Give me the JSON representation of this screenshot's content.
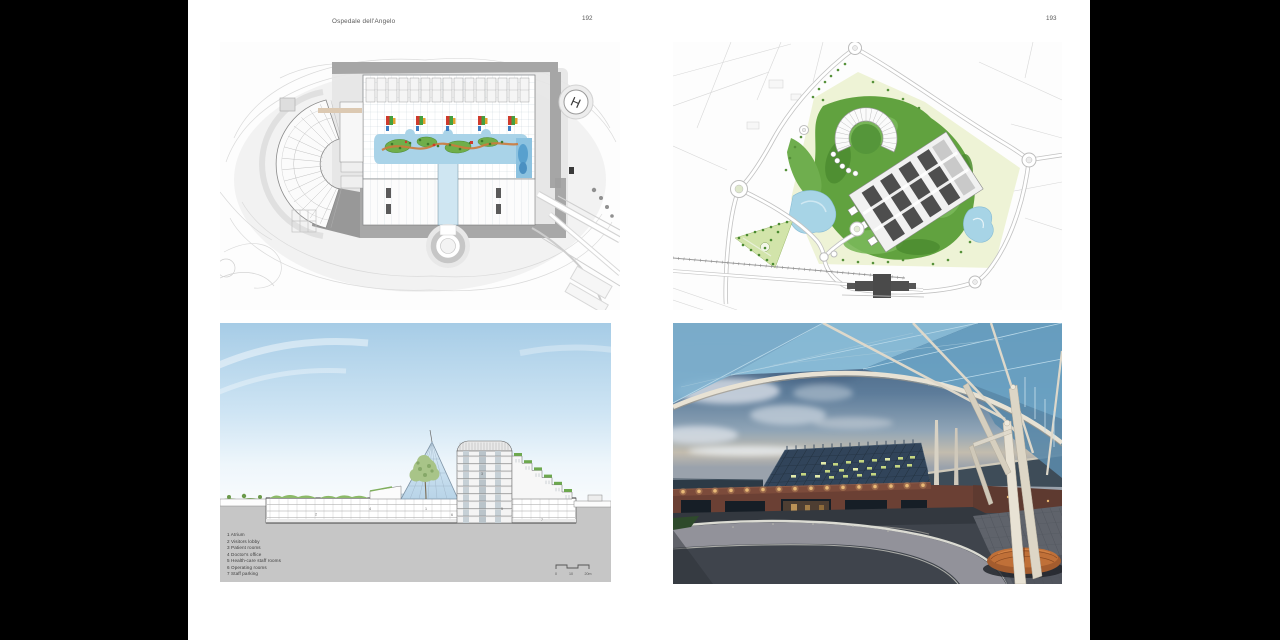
{
  "canvas": {
    "background": "#000000",
    "paper_color": "#ffffff"
  },
  "spread": {
    "left_page": {
      "header_title": "Ospedale dell'Angelo",
      "page_number": "192"
    },
    "right_page": {
      "page_number": "193"
    }
  },
  "figures": {
    "floor_plan": {
      "helipad_label": "H",
      "colors": {
        "garden_water": "#a9d3e8",
        "garden_green": "#6fae4a",
        "path_orange": "#cc7a3c",
        "accent_red": "#cf3a2c",
        "site_gray": "#e6e6e6"
      }
    },
    "site_plan": {
      "colors": {
        "park_pale": "#eef3d6",
        "woodland_green": "#61a23f",
        "pond_blue": "#a7d4e6",
        "building_slab": "#4e4e4e"
      }
    },
    "section": {
      "legend": [
        "1 Atrium",
        "2 Visitors lobby",
        "3 Patient rooms",
        "4 Doctor's office",
        "5 Health-care staff rooms",
        "6 Operating rooms",
        "7 Staff parking"
      ],
      "figure_keys": [
        "1",
        "2",
        "3",
        "4",
        "5",
        "6",
        "7"
      ],
      "scale_bar": {
        "tick_0": "0",
        "tick_10": "10",
        "tick_20": "20m"
      },
      "colors": {
        "sky_top": "#a6cce6",
        "ground_gray": "#c6c6c6",
        "glass_blue": "#cfe4f2",
        "tree_green": "#a8c488"
      }
    },
    "photo": {
      "colors": {
        "dusk_sky": "#3a5574",
        "canopy_glass": "#7fb2d0",
        "structure_white": "#e8e2d4",
        "brick": "#6b4034",
        "window_light": "#cdde84",
        "bench_wood": "#a45c2e"
      }
    }
  }
}
